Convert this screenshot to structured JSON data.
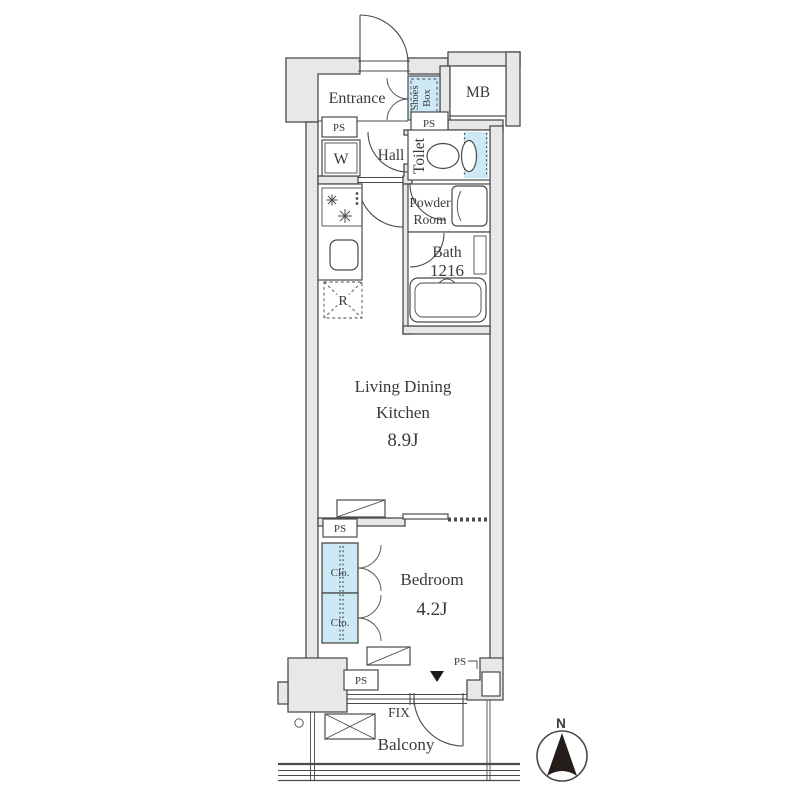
{
  "palette": {
    "wall": "#e8e8e8",
    "line": "#4a4a4a",
    "water": "#cde9f6",
    "ink": "#3a3a3a",
    "needle": "#241d1a"
  },
  "labels": {
    "entrance": "Entrance",
    "shoes_box_line1": "Shoes",
    "shoes_box_line2": "Box",
    "mb": "MB",
    "ps": "PS",
    "washer": "W",
    "hall": "Hall",
    "toilet": "Toilet",
    "powder_line1": "Powder",
    "powder_line2": "Room",
    "bath_line1": "Bath",
    "bath_line2": "1216",
    "refrigerator": "R",
    "ldk_line1": "Living Dining",
    "ldk_line2": "Kitchen",
    "ldk_line3": "8.9J",
    "bedroom_line1": "Bedroom",
    "bedroom_line2": "4.2J",
    "closet": "Clo.",
    "fix": "FIX",
    "balcony": "Balcony",
    "compass_north": "N"
  }
}
